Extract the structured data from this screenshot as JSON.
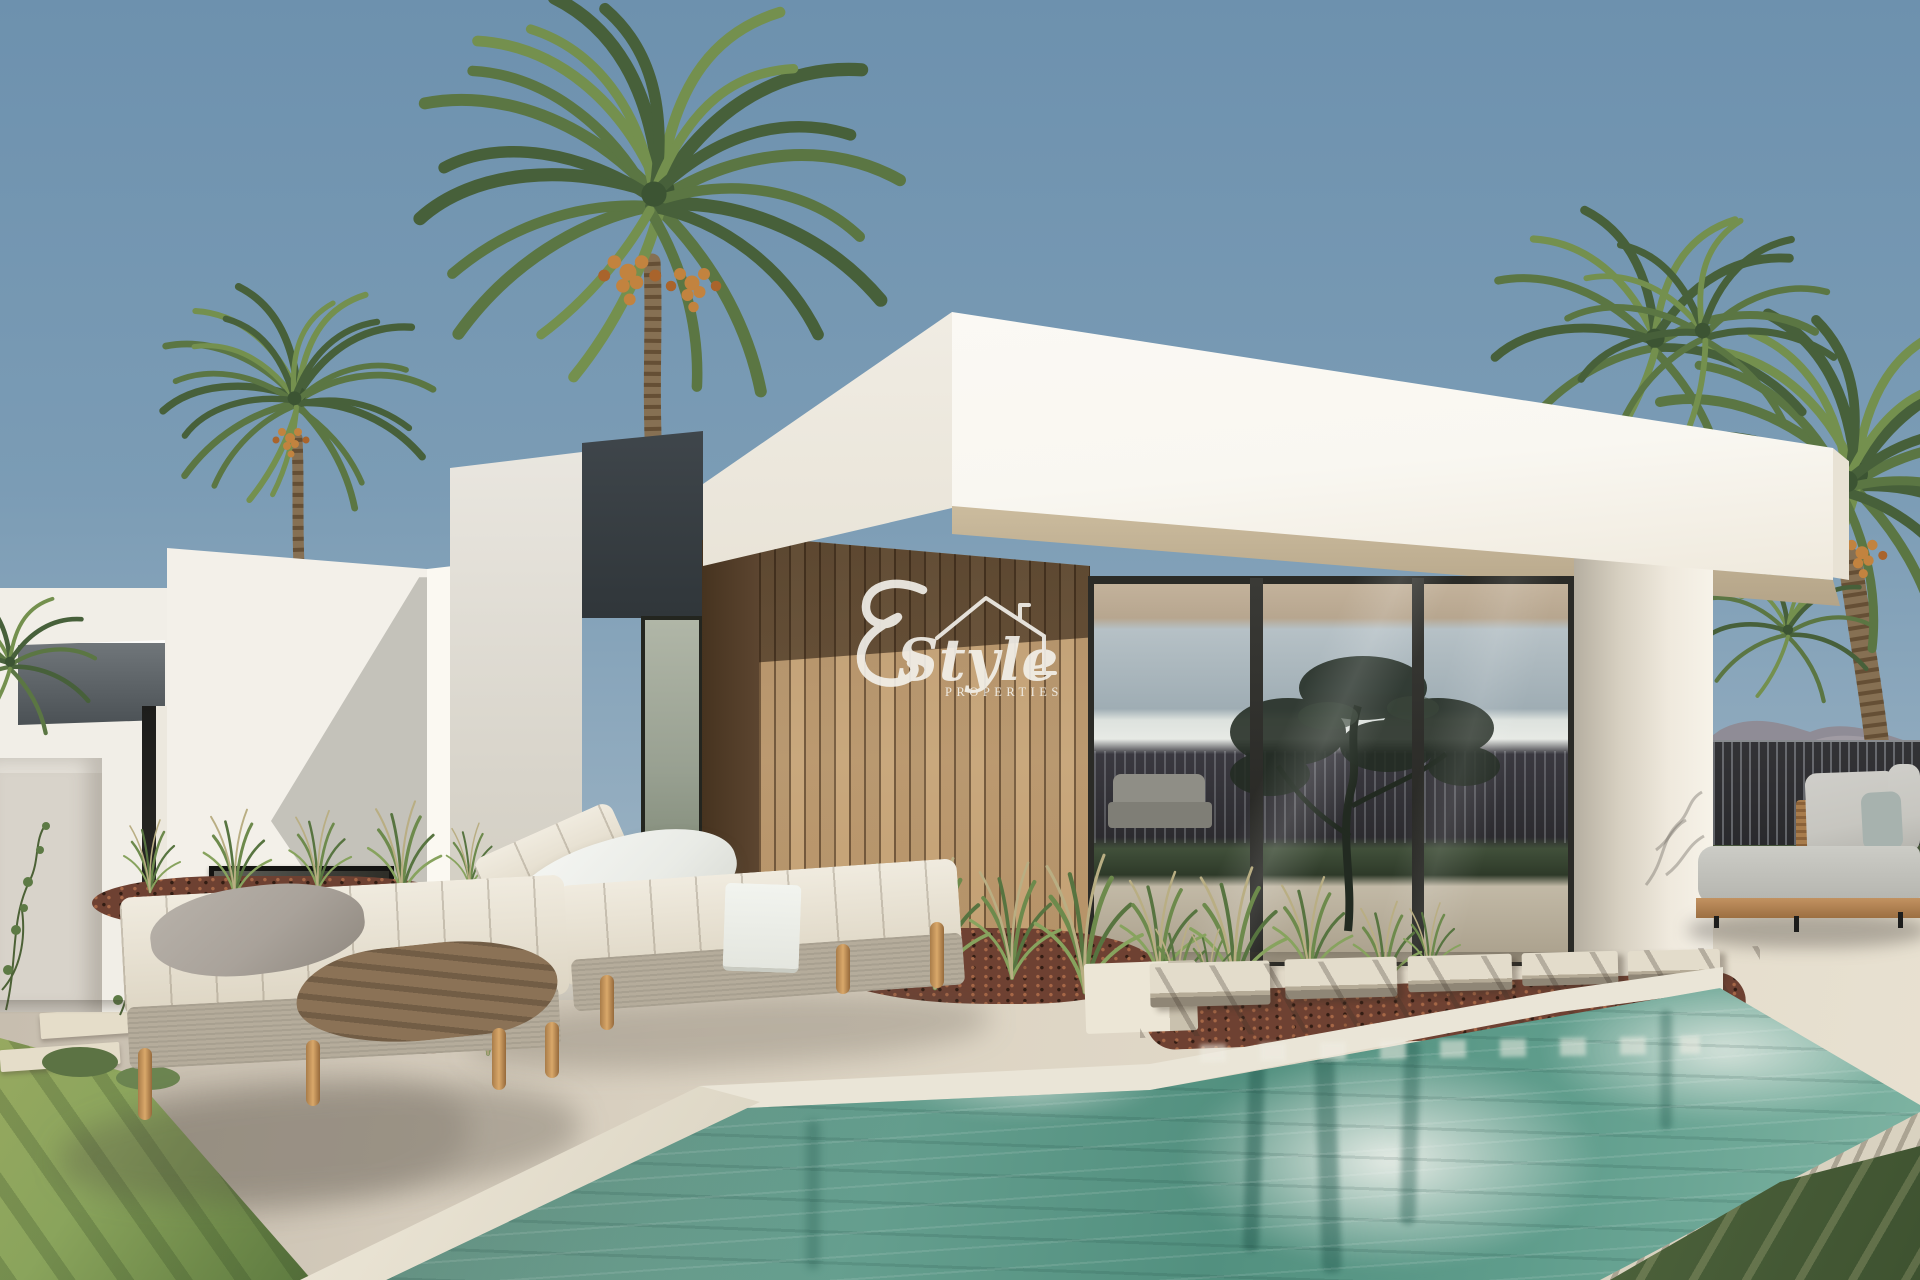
{
  "watermark": {
    "monogram": "E",
    "name": "Style",
    "subtitle": "PROPERTIES"
  },
  "palette": {
    "sky_top": "#6d91ae",
    "sky_horizon": "#c2cdd1",
    "roof_white": "#f9f7f1",
    "roof_shade": "#e9e4d8",
    "charcoal_panel": "#3f464b",
    "wood_sunlit": "#c9a87d",
    "wood_shadow": "#5f4731",
    "glass_frame": "#2b2b27",
    "fence_slat": "#29292c",
    "mountain_haze": "#8f8a93",
    "pillar_white": "#efe9dd",
    "deck_stone": "#d9d0c0",
    "pool_shallow": "#a9ccbc",
    "pool_deep": "#52907f",
    "pool_reflection": "#eef0e9",
    "lawn_sunlit": "#8aa45c",
    "lawn_shaded": "#3e5230",
    "mulch_brown": "#6e4132",
    "cushion_cream": "#ddd5c3",
    "cushion_gray": "#a9a29a",
    "sofa_gray": "#c7c6c0",
    "teak_wood": "#9c6f42",
    "palm_green": "#50703f",
    "date_orange": "#c2833f",
    "watermark_white": "#f4f2ec"
  },
  "scene": {
    "type": "architectural_exterior_render",
    "description": "Photorealistic render of a modern flat-roof villa with a vertical wood-slat feature wall, full-height glazing, date palms, two cream sun loungers, a gray outdoor sofa, stepping stones and a turquoise pool under a clear steel-blue sky",
    "buildings": [
      "white cantilevered flat roof slab",
      "charcoal accent panel",
      "wood-slat feature wall",
      "full-height glass wall with dark mullions",
      "white corner pillar",
      "secondary white volume with dark fascia and ribbon window",
      "low boundary wall with climbing vine"
    ],
    "landscape": [
      "date palm trees with orange fruit clusters",
      "ornamental grass tufts",
      "red-brown mulch planting beds",
      "striped lawns",
      "distant mauve mountain ridge",
      "dark slatted privacy fence"
    ],
    "furniture": [
      "flat sun lounger with gray pillow and brown throw",
      "reclined sun lounger with white pillow and towel",
      "gray outdoor sofa on teak base"
    ],
    "pool": [
      "pale stone coping",
      "row of stepping stones",
      "turquoise water with white building and palm-trunk reflections"
    ]
  }
}
